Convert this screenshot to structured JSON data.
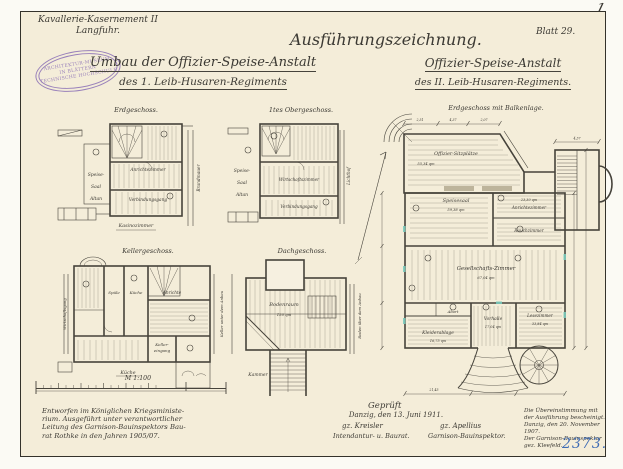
{
  "header": {
    "corner_mark": "1",
    "unit_line1": "Kavallerie-Kasernement II",
    "unit_line2": "Langfuhr.",
    "main_title": "Ausführungszeichnung.",
    "sheet_no": "Blatt 29.",
    "left_title_line1": "Umbau der Offizier-Speise-Anstalt",
    "left_title_line2": "des 1. Leib-Husaren-Regiments",
    "right_title_line1": "Offizier-Speise-Anstalt",
    "right_title_line2": "des II. Leib-Husaren-Regiments."
  },
  "stamp": {
    "top": "ARCHITEKTUR-MUSEUM",
    "middle": "IN BLÄTTERN",
    "bottom": "TECHNISCHE HOCHSCHULE"
  },
  "plan_erdgeschoss": {
    "title": "Erdgeschoss.",
    "label_speise": "Speise-",
    "label_saal": "Saal",
    "label_altan": "Altan",
    "label_anrichte": "Anrichtezimmer",
    "label_gang": "Verbindungsgang",
    "label_kasino": "Kasinozimmer",
    "label_brandmauer": "Brandmauer"
  },
  "plan_obergeschoss": {
    "title": "1tes Obergeschoss.",
    "label_speise": "Speise-",
    "label_saal": "Saal",
    "label_altan": "Altan",
    "label_wirtschaft": "Wirtschaftszimmer",
    "label_gang": "Verbindungsgang",
    "label_lichthof": "Lichthof"
  },
  "plan_kellergeschoss": {
    "title": "Kellergeschoss.",
    "label_spuele": "Spüle",
    "label_kueche": "Küche",
    "label_anrichte": "Anrichte",
    "label_keller1": "Keller-",
    "label_keller2": "eingang",
    "label_links": "Wirtschaftsgang",
    "label_rechts": "Keller unter dem Anbau",
    "label_unten": "Küche"
  },
  "plan_dachgeschoss": {
    "title": "Dachgeschoss.",
    "label_boden": "Bodenraum",
    "label_qm": "150 qm",
    "label_rechts": "Boden über dem Anbau",
    "label_kammer": "Kammer"
  },
  "plan_balkenlage": {
    "title": "Erdgeschoss mit Balkenlage.",
    "label_sitzplaetze": "Offizier-Sitzplätze",
    "qm_sitzplaetze": "55,34 qm",
    "label_speisesaal": "Speisesaal",
    "qm_speisesaal": "59,38 qm",
    "label_anrichte": "Anrichtezimmer",
    "qm_anrichte": "23,30 qm",
    "label_rauch": "Rauchzimmer",
    "label_gesellschaft": "Gesellschafts-Zimmer",
    "qm_gesellschaft": "67,04 qm",
    "label_abort": "Abort",
    "label_kleider": "Kleiderablage",
    "qm_kleider": "16,75 qm",
    "label_vorhalle": "Vorhalle",
    "qm_vorhalle": "17,04 qm",
    "label_lese": "Lesezimmer",
    "qm_lese": "33,84 qm",
    "dim1": "2,51",
    "dim2": "4,37",
    "dim3": "2,07",
    "dim4": "4,37",
    "dim_bottom": "21,45"
  },
  "scale": {
    "label": "M 1:100"
  },
  "note_left": {
    "line1": "Entworfen im Königlichen Kriegsministe-",
    "line2": "rium. Ausgeführt unter verantwortlicher",
    "line3": "Leitung des Garnison-Bauinspektors Bau-",
    "line4": "rat Rothke in den Jahren 1905/07."
  },
  "approval": {
    "line1": "Geprüft",
    "line2": "Danzig, den 13. Juni 1911.",
    "sig_left": "gz. Kreisler",
    "sig_right": "gz. Apellius",
    "title_left": "Intendantur- u. Baurat.",
    "title_right": "Garnison-Bauinspektor."
  },
  "certification": {
    "line1": "Die Übereinstimmung mit",
    "line2": "der Ausführung bescheinigt.",
    "line3": "Danzig, den 20. November 1907.",
    "line4": "Der Garnison-Bauinspektor",
    "line5": "gez. Kleefeld."
  },
  "inventory_no": "2373."
}
